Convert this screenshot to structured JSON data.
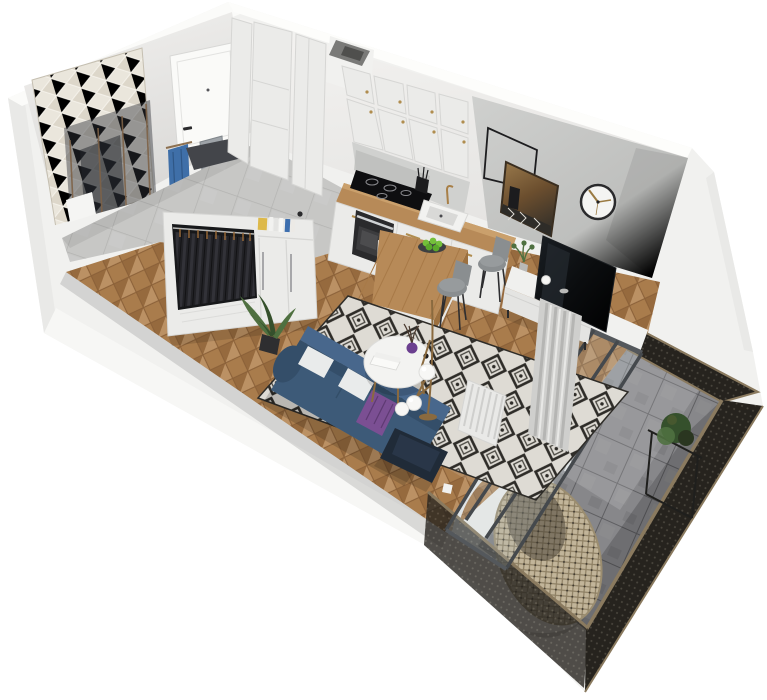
{
  "canvas": {
    "width": 767,
    "height": 700
  },
  "scene": {
    "type": "isometric-3d-render-studio-apartment-floor-plan",
    "rooms": [
      "bathroom",
      "entry-hallway",
      "kitchen",
      "living-room",
      "balcony"
    ],
    "objects": [
      "chevron-tile-wall",
      "shower-glass-panels",
      "blue-towel",
      "entry-door",
      "door-mat",
      "tall-cabinet-columns",
      "ventilation-duct",
      "kitchen-upper-cabinets",
      "backsplash",
      "induction-cooktop",
      "oven",
      "kitchen-counter",
      "sink",
      "faucet",
      "utensil-cup",
      "pepper-mill",
      "kitchen-base-cabinets",
      "wood-peninsula",
      "fruit-plate-with-apples",
      "bar-stool",
      "bar-stool",
      "gray-accent-wall",
      "empty-picture-frame",
      "wall-mirror",
      "wall-clock",
      "tv",
      "tv-console",
      "console-plant",
      "radiator",
      "curtain",
      "glass-balcony-door",
      "open-wardrobe",
      "hanging-clothes",
      "shelf-books",
      "wardrobe-doors",
      "herringbone-wood-floor",
      "hallway-tile-floor",
      "diamond-pattern-rug",
      "blue-sofa",
      "white-pillows",
      "purple-throw",
      "navy-ottoman",
      "potted-plant",
      "round-coffee-table",
      "book-stack",
      "purple-vase",
      "black-cups",
      "globe-floor-lamp",
      "balcony-tile-floor",
      "mesh-railing-panels",
      "hanging-egg-chair",
      "egg-chair-stand",
      "balcony-plant-table",
      "balcony-plant"
    ]
  },
  "palette": {
    "wall_white": "#f1f1ef",
    "wall_highlight": "#fbfbf9",
    "wall_shadow": "#e9e9e7",
    "wall_gray": "#c7c8c6",
    "wall_gray_dark": "#b2b3b1",
    "chevron_light": "#eae6dc",
    "chevron_dark": "#cfc9bb",
    "door_white": "#fafaf8",
    "glass_smoke": "#2f343a",
    "glass_frame_bronze": "#7d6247",
    "towel_blue": "#3f6fa8",
    "tile_hall": "#c7c7c5",
    "tile_grout": "#b3b3b1",
    "wood_floor": "#a97c4c",
    "wood_floor_light": "#bb9164",
    "wood_floor_dark": "#8a6038",
    "cabinet_white": "#ebebe9",
    "cabinet_line": "#d6d6d4",
    "brass": "#b08d4f",
    "counter_wood": "#b78a58",
    "counter_wood_dark": "#9c703f",
    "cooktop_black": "#0e0e10",
    "oven_dark": "#2a2a2c",
    "steel": "#cfd2d4",
    "sink_white": "#f2f2f0",
    "apple_green": "#74c03a",
    "plate_dark": "#3d3f41",
    "stool_gray": "#8a8e90",
    "rug_bg": "#dedbd4",
    "rug_dark": "#2e2c28",
    "sofa_blue": "#3d5a78",
    "sofa_blue_light": "#48678c",
    "sofa_blue_dark": "#344e69",
    "pillow_white": "#e9ebeb",
    "throw_purple": "#7b4f93",
    "ottoman_navy": "#202b38",
    "table_white": "#f3f3f1",
    "vase_purple": "#6b3f8f",
    "cup_black": "#1c1c1e",
    "lamp_globe": "#f7f7f5",
    "plant_green": "#4f7040",
    "plant_green_dark": "#35502c",
    "pot_black": "#2e2e30",
    "tv_black": "#0b0d0f",
    "console_white": "#f0f0ee",
    "radiator_white": "#e9e9e7",
    "curtain_gray": "#cfcfcd",
    "curtain_dark": "#b5b5b3",
    "window_frame": "#45494d",
    "balcony_tile": "#87878a",
    "balcony_tile_dark": "#6c6c6f",
    "balcony_grout": "#5f5f62",
    "mesh_dark": "#26231e",
    "mesh_dot": "#4a463e",
    "mesh_frame": "#8a7a5f",
    "rattan_light": "#c2b59a",
    "rattan_dark": "#8d7f63",
    "clock_rim": "#2a2a2c",
    "clock_face": "#f4f4f2",
    "clock_hand": "#9a7a42",
    "mirror_wood": "#8a6a42",
    "frame_black": "#1d1d1f"
  }
}
